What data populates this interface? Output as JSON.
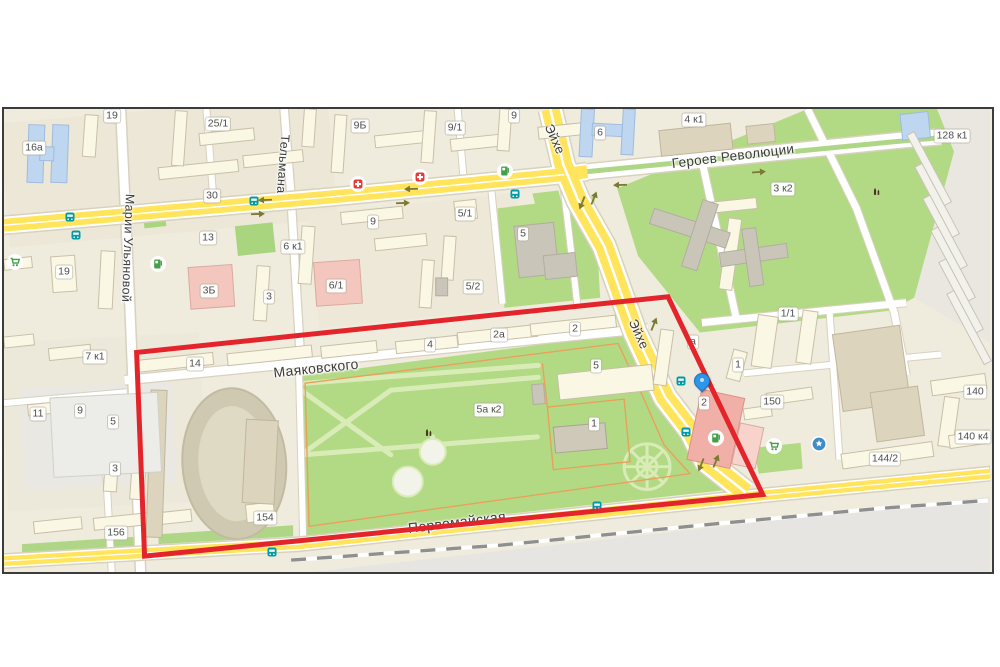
{
  "map": {
    "frame": {
      "left": 2,
      "top": 107,
      "width": 992,
      "height": 467,
      "border_color": "#3c3c3c"
    },
    "palette": {
      "background_beige": "#EFEBDD",
      "road_yellow": "#FFE45C",
      "road_white": "#FFFFFF",
      "park_green": "#B2DA85",
      "path_green": "#D9ECB8",
      "building_cream": "#FBF7E5",
      "building_tan": "#DCD4BC",
      "building_gray": "#C9C5B8",
      "building_blue": "#BED6F0",
      "building_pink": "#F3C6BE",
      "railway_gray": "#E7E5E1",
      "selection_red": "#E3242B",
      "pin_blue": "#2E96E8",
      "bus_teal": "#0099A5",
      "pharmacy_red": "#E53935",
      "poi_green": "#43A047",
      "poi_blue": "#3F8CC6",
      "monument_brown": "#4A3526",
      "park_border_orange": "#EC9F5B"
    },
    "selection_polygon": {
      "color": "#E3242B",
      "points": "133,245 666,189 761,388 141,450"
    },
    "pin": {
      "x": 698,
      "y": 278
    },
    "street_labels": [
      {
        "text": "Марии Ульяновой",
        "x": 124,
        "y": 139,
        "rotate": 92,
        "size": 12.5
      },
      {
        "text": "Тельмана",
        "x": 279,
        "y": 55,
        "rotate": 94,
        "size": 12.5
      },
      {
        "text": "Эйхе",
        "x": 551,
        "y": 30,
        "rotate": 66,
        "size": 13
      },
      {
        "text": "Эйхе",
        "x": 635,
        "y": 225,
        "rotate": 66,
        "size": 13
      },
      {
        "text": "Героев Революции",
        "x": 729,
        "y": 47,
        "rotate": -7,
        "size": 13.5
      },
      {
        "text": "Маяковского",
        "x": 312,
        "y": 259,
        "rotate": -6,
        "size": 14
      },
      {
        "text": "Первомайская",
        "x": 453,
        "y": 413,
        "rotate": -7,
        "size": 14
      }
    ],
    "house_numbers": [
      {
        "text": "16а",
        "x": 30,
        "y": 39
      },
      {
        "text": "19",
        "x": 108,
        "y": 7
      },
      {
        "text": "25/1",
        "x": 214,
        "y": 15
      },
      {
        "text": "9Б",
        "x": 356,
        "y": 17
      },
      {
        "text": "9/1",
        "x": 451,
        "y": 19
      },
      {
        "text": "9",
        "x": 510,
        "y": 7
      },
      {
        "text": "6",
        "x": 596,
        "y": 24
      },
      {
        "text": "4 к1",
        "x": 690,
        "y": 11
      },
      {
        "text": "128 к1",
        "x": 948,
        "y": 27
      },
      {
        "text": "30",
        "x": 208,
        "y": 87
      },
      {
        "text": "13",
        "x": 204,
        "y": 129
      },
      {
        "text": "3 к2",
        "x": 779,
        "y": 80
      },
      {
        "text": "19",
        "x": 60,
        "y": 163
      },
      {
        "text": "6 к1",
        "x": 289,
        "y": 138
      },
      {
        "text": "9",
        "x": 369,
        "y": 113
      },
      {
        "text": "5/1",
        "x": 461,
        "y": 105
      },
      {
        "text": "5",
        "x": 519,
        "y": 125
      },
      {
        "text": "3Б",
        "x": 205,
        "y": 182
      },
      {
        "text": "3",
        "x": 265,
        "y": 188
      },
      {
        "text": "6/1",
        "x": 332,
        "y": 177
      },
      {
        "text": "5/2",
        "x": 469,
        "y": 178
      },
      {
        "text": "7 к1",
        "x": 91,
        "y": 248
      },
      {
        "text": "14",
        "x": 191,
        "y": 255
      },
      {
        "text": "4",
        "x": 426,
        "y": 236
      },
      {
        "text": "2а",
        "x": 495,
        "y": 226
      },
      {
        "text": "2",
        "x": 571,
        "y": 220
      },
      {
        "text": "5",
        "x": 592,
        "y": 257
      },
      {
        "text": "1/1",
        "x": 784,
        "y": 205
      },
      {
        "text": "а",
        "x": 689,
        "y": 233
      },
      {
        "text": "1",
        "x": 734,
        "y": 256
      },
      {
        "text": "5а к2",
        "x": 485,
        "y": 301
      },
      {
        "text": "1",
        "x": 590,
        "y": 315
      },
      {
        "text": "2",
        "x": 700,
        "y": 294
      },
      {
        "text": "150",
        "x": 768,
        "y": 293
      },
      {
        "text": "140",
        "x": 971,
        "y": 283
      },
      {
        "text": "140 к4",
        "x": 969,
        "y": 328
      },
      {
        "text": "144/2",
        "x": 881,
        "y": 350
      },
      {
        "text": "11",
        "x": 34,
        "y": 305
      },
      {
        "text": "9",
        "x": 76,
        "y": 302
      },
      {
        "text": "5",
        "x": 109,
        "y": 313
      },
      {
        "text": "3",
        "x": 111,
        "y": 360
      },
      {
        "text": "156",
        "x": 112,
        "y": 424
      },
      {
        "text": "154",
        "x": 261,
        "y": 409
      }
    ],
    "pois": [
      {
        "type": "pharmacy-icon",
        "x": 354,
        "y": 75
      },
      {
        "type": "pharmacy-icon",
        "x": 416,
        "y": 68
      },
      {
        "type": "fuel-station-icon",
        "x": 154,
        "y": 155
      },
      {
        "type": "fuel-station-icon",
        "x": 501,
        "y": 62
      },
      {
        "type": "fuel-station-icon",
        "x": 712,
        "y": 329
      },
      {
        "type": "supermarket-icon",
        "x": 11,
        "y": 153
      },
      {
        "type": "supermarket-icon",
        "x": 770,
        "y": 337
      },
      {
        "type": "services-poi-icon",
        "x": 815,
        "y": 335
      },
      {
        "type": "monument-icon",
        "x": 872,
        "y": 81
      },
      {
        "type": "monument-icon",
        "x": 424,
        "y": 322
      },
      {
        "type": "bus-stop-icon",
        "x": 66,
        "y": 108
      },
      {
        "type": "bus-stop-icon",
        "x": 72,
        "y": 126
      },
      {
        "type": "bus-stop-icon",
        "x": 250,
        "y": 92
      },
      {
        "type": "bus-stop-icon",
        "x": 511,
        "y": 85
      },
      {
        "type": "bus-stop-icon",
        "x": 677,
        "y": 272
      },
      {
        "type": "bus-stop-icon",
        "x": 682,
        "y": 323
      },
      {
        "type": "bus-stop-icon",
        "x": 268,
        "y": 443
      },
      {
        "type": "bus-stop-icon",
        "x": 593,
        "y": 397
      }
    ],
    "traffic_arrows": [
      {
        "x": 407,
        "y": 80,
        "rotate": 178
      },
      {
        "x": 399,
        "y": 94,
        "rotate": -2
      },
      {
        "x": 261,
        "y": 91,
        "rotate": 178
      },
      {
        "x": 254,
        "y": 105,
        "rotate": -2
      },
      {
        "x": 650,
        "y": 215,
        "rotate": -68
      },
      {
        "x": 712,
        "y": 352,
        "rotate": -68
      },
      {
        "x": 697,
        "y": 356,
        "rotate": 112
      },
      {
        "x": 578,
        "y": 94,
        "rotate": 112
      },
      {
        "x": 590,
        "y": 89,
        "rotate": -68
      },
      {
        "x": 755,
        "y": 63,
        "rotate": -4
      },
      {
        "x": 616,
        "y": 76,
        "rotate": 178
      }
    ]
  }
}
